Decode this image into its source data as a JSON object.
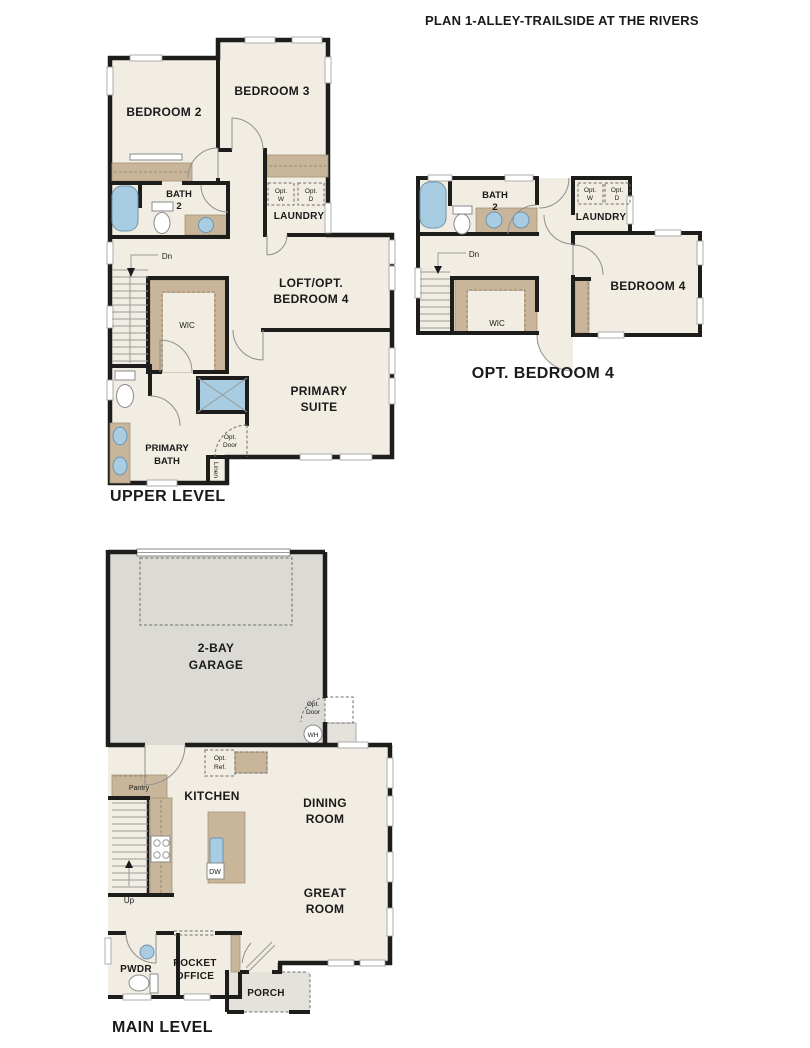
{
  "title": "PLAN 1-ALLEY-TRAILSIDE AT THE RIVERS",
  "colors": {
    "wall": "#1d1d1b",
    "floor": "#f2ede2",
    "counter": "#c9b69a",
    "garage": "#dcdad5",
    "porch": "#e5e2dc",
    "fixture_blue": "#a8cce2"
  },
  "upper_level": {
    "caption": "UPPER LEVEL",
    "rooms": {
      "bedroom2": "BEDROOM 2",
      "bedroom3": "BEDROOM 3",
      "bath2_1": "BATH",
      "bath2_2": "2",
      "laundry": "LAUNDRY",
      "loft_1": "LOFT/OPT.",
      "loft_2": "BEDROOM 4",
      "wic": "WIC",
      "primary_suite_1": "PRIMARY",
      "primary_suite_2": "SUITE",
      "primary_bath_1": "PRIMARY",
      "primary_bath_2": "BATH"
    },
    "annotations": {
      "opt_w_1": "Opt.",
      "opt_w_2": "W",
      "opt_d_1": "Opt.",
      "opt_d_2": "D",
      "dn": "Dn",
      "opt_door_1": "Opt.",
      "opt_door_2": "Door",
      "linen": "Linen"
    }
  },
  "opt_bedroom4_plan": {
    "caption": "OPT. BEDROOM 4",
    "rooms": {
      "bath2_1": "BATH",
      "bath2_2": "2",
      "laundry": "LAUNDRY",
      "wic": "WIC",
      "bedroom4": "BEDROOM 4"
    },
    "annotations": {
      "opt_w_1": "Opt.",
      "opt_w_2": "W",
      "opt_d_1": "Opt.",
      "opt_d_2": "D",
      "dn": "Dn"
    }
  },
  "main_level": {
    "caption": "MAIN LEVEL",
    "rooms": {
      "garage_1": "2-BAY",
      "garage_2": "GARAGE",
      "kitchen": "KITCHEN",
      "pantry": "Pantry",
      "dining_1": "DINING",
      "dining_2": "ROOM",
      "great_1": "GREAT",
      "great_2": "ROOM",
      "pwdr": "PWDR",
      "pocket_1": "POCKET",
      "pocket_2": "OFFICE",
      "porch": "PORCH"
    },
    "annotations": {
      "opt_door_1": "Opt.",
      "opt_door_2": "Door",
      "wh": "WH",
      "opt_ref_1": "Opt.",
      "opt_ref_2": "Ref.",
      "dw": "DW",
      "up": "Up"
    }
  }
}
